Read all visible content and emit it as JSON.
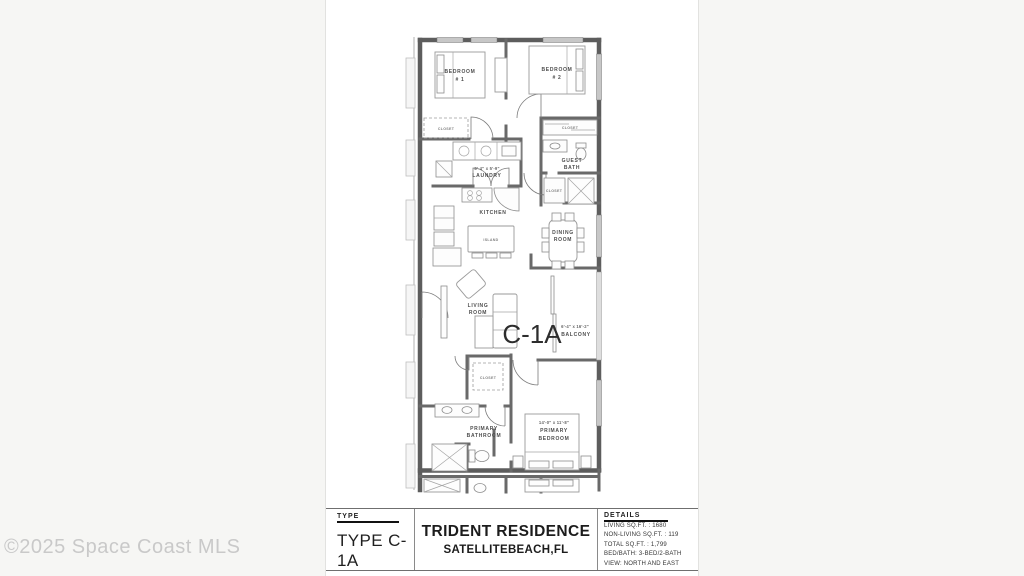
{
  "watermark": "©2025 Space Coast MLS",
  "plan": {
    "unit_code": "C-1A",
    "labels": {
      "bedroom1_line1": "BEDROOM",
      "bedroom1_line2": "# 1",
      "bedroom2_line1": "BEDROOM",
      "bedroom2_line2": "# 2",
      "closet": "CLOSET",
      "guest_bath_line1": "GUEST",
      "guest_bath_line2": "BATH",
      "laundry_dim": "8'-4\" x 5'-9\"",
      "laundry": "LAUNDRY",
      "kitchen": "KITCHEN",
      "island": "ISLAND",
      "dining_line1": "DINING",
      "dining_line2": "ROOM",
      "living_line1": "LIVING",
      "living_line2": "ROOM",
      "balcony_dim": "6'-4\" x 16'-2\"",
      "balcony": "BALCONY",
      "primary_bath_line1": "PRIMARY",
      "primary_bath_line2": "BATHROOM",
      "primary_bed_dim": "14'-0\" x 11'-8\"",
      "primary_bed_line1": "PRIMARY",
      "primary_bed_line2": "BEDROOM"
    }
  },
  "title_block": {
    "type_header": "TYPE",
    "type_value": "TYPE C-1A",
    "residence_name": "TRIDENT RESIDENCE",
    "residence_location": "SATELLITEBEACH,FL",
    "details_header": "DETAILS",
    "details": [
      "LIVING SQ.FT. : 1680",
      "NON-LIVING SQ.FT. : 119",
      "TOTAL SQ.FT. : 1,799",
      "BED/BATH: 3-BED/2-BATH",
      "VIEW: NORTH AND EAST"
    ]
  }
}
